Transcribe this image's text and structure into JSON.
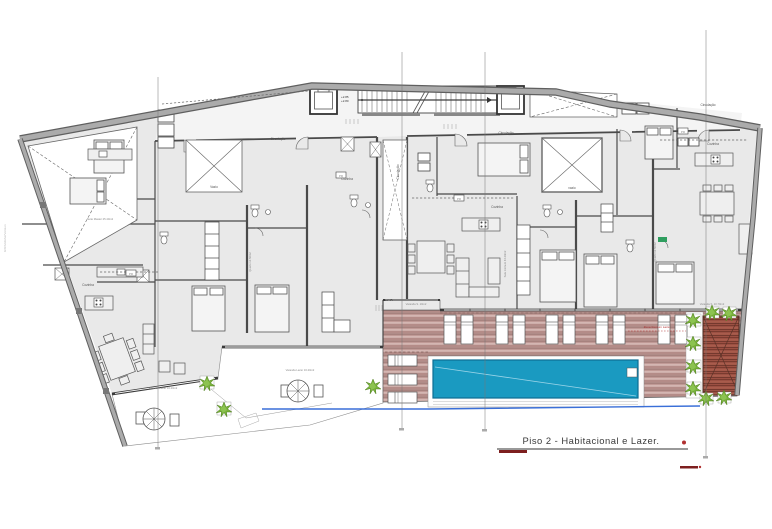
{
  "title": {
    "text": "Piso 2 - Habitacional e Lazer."
  },
  "labels": {
    "circulacao": "Circulação",
    "cozinha": "Cozinha",
    "pr": "PR",
    "vazio": "Vazio",
    "vazio_lower": "vazio",
    "varanda_lazer": "Varanda Lazer 16.20m2",
    "varanda_s": "Varanda S. 10m2",
    "varanda_d": "Varanda S. 10.70m2",
    "zona_comum": "Zona Comum Lazer",
    "level_a": "+2.85",
    "level_b": "+2.80",
    "level_c": "+2.35",
    "suite": "Suite Master 25.40m2",
    "quarto": "Quarto 12.50m2",
    "sala": "Sala Comum 44.20m2",
    "watermark": "GSPublisherVersion"
  },
  "colors": {
    "pool": "#1a9ac1",
    "pool_border": "#0e6d93",
    "deck_light": "#c6a29e",
    "deck_dark": "#9c5043",
    "plant_green": "#79b23c",
    "railing_blue": "#3a6fd8",
    "accent_red": "#7d1f1f",
    "dot_red": "#b03030",
    "wall_gray": "#a8a8a8",
    "room_fill": "#e9e9e9",
    "line": "#4a4a4a"
  }
}
